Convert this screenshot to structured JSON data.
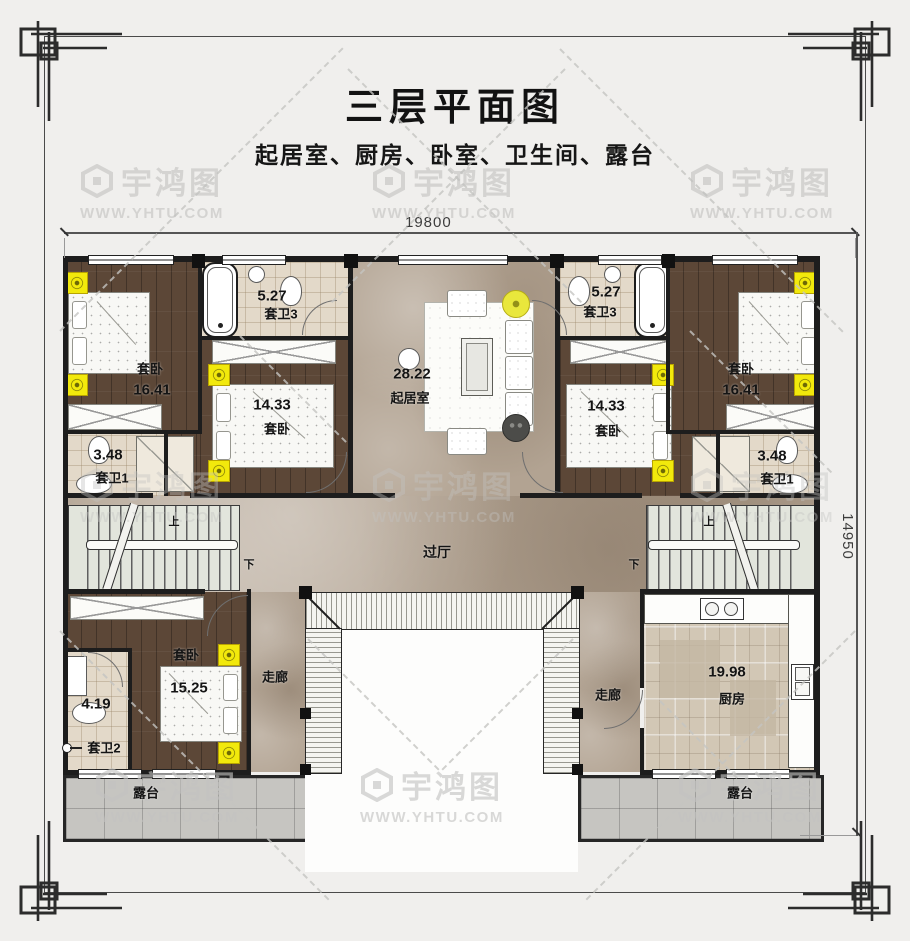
{
  "title": "三层平面图",
  "subtitle": "起居室、厨房、卧室、卫生间、露台",
  "watermark": {
    "brand": "宇鸿图",
    "url": "WWW.YHTU.COM"
  },
  "dimensions": {
    "top": "19800",
    "right": "14950"
  },
  "stairs": {
    "up": "上",
    "down": "下"
  },
  "rooms": {
    "bedroom16": {
      "name": "套卧",
      "area": "16.41"
    },
    "bath3": {
      "name": "套卫3",
      "area": "5.27"
    },
    "bedroom14": {
      "name": "套卧",
      "area": "14.33"
    },
    "bath1": {
      "name": "套卫1",
      "area": "3.48"
    },
    "living": {
      "name": "起居室",
      "area": "28.22"
    },
    "hall": {
      "name": "过厅"
    },
    "bedroom15": {
      "name": "套卧",
      "area": "15.25"
    },
    "bath2": {
      "name": "套卫2",
      "area": "4.19"
    },
    "corridor": {
      "name": "走廊"
    },
    "kitchen": {
      "name": "厨房",
      "area": "19.98"
    },
    "terrace": {
      "name": "露台"
    }
  },
  "colors": {
    "wall": "#1d1d1d",
    "wood_floor": "#5c4737",
    "marble_floor": "#b2a392",
    "bath_tile": "#e3d9c9",
    "kitchen_tile": "#d2c7b5",
    "terrace_tile": "#c6c5c1",
    "highlight_yellow": "#f2e90c",
    "watermark_gray": "#c3c3c1"
  }
}
